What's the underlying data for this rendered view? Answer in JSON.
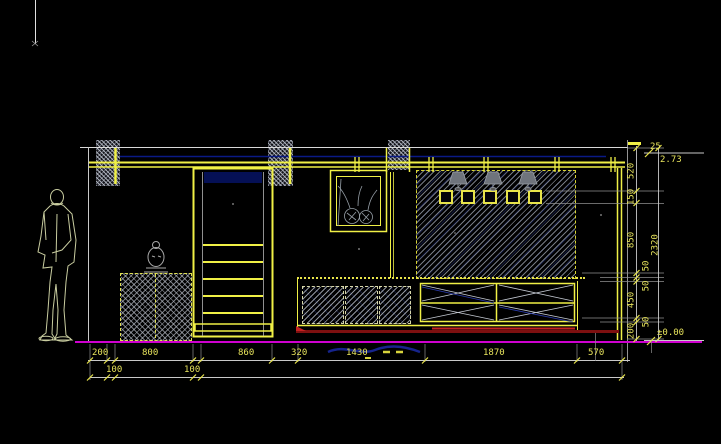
{
  "drawing": {
    "dims": {
      "bottom_row1": [
        "200",
        "800",
        "860",
        "320",
        "1430",
        "1870",
        "570"
      ],
      "bottom_sub": [
        "100",
        "100"
      ],
      "right_chain": [
        "520",
        "150",
        "850",
        "50",
        "50",
        "450",
        "50",
        "200"
      ],
      "right_total": "2320",
      "top_gap": "25"
    },
    "levels": {
      "top_level": "2.73",
      "floor_level": "±0.00"
    },
    "colors": {
      "cad_yellow": "#f0f046",
      "dim_text_yellow": "#e8e45c",
      "floor_magenta": "#cf00cf",
      "skirting_red": "#c32222",
      "line_white": "#d9d9d9",
      "structure_navy": "#0a1a86",
      "hatch_gray": "#9aa0a8"
    },
    "icons": {
      "person": "person-figure",
      "statue": "buddha-statue-icon",
      "artwork": "vase-artwork-icon",
      "lamp": "wall-lamp-icon",
      "niche": "display-niche",
      "level_marker": "level-flag-icon"
    }
  }
}
